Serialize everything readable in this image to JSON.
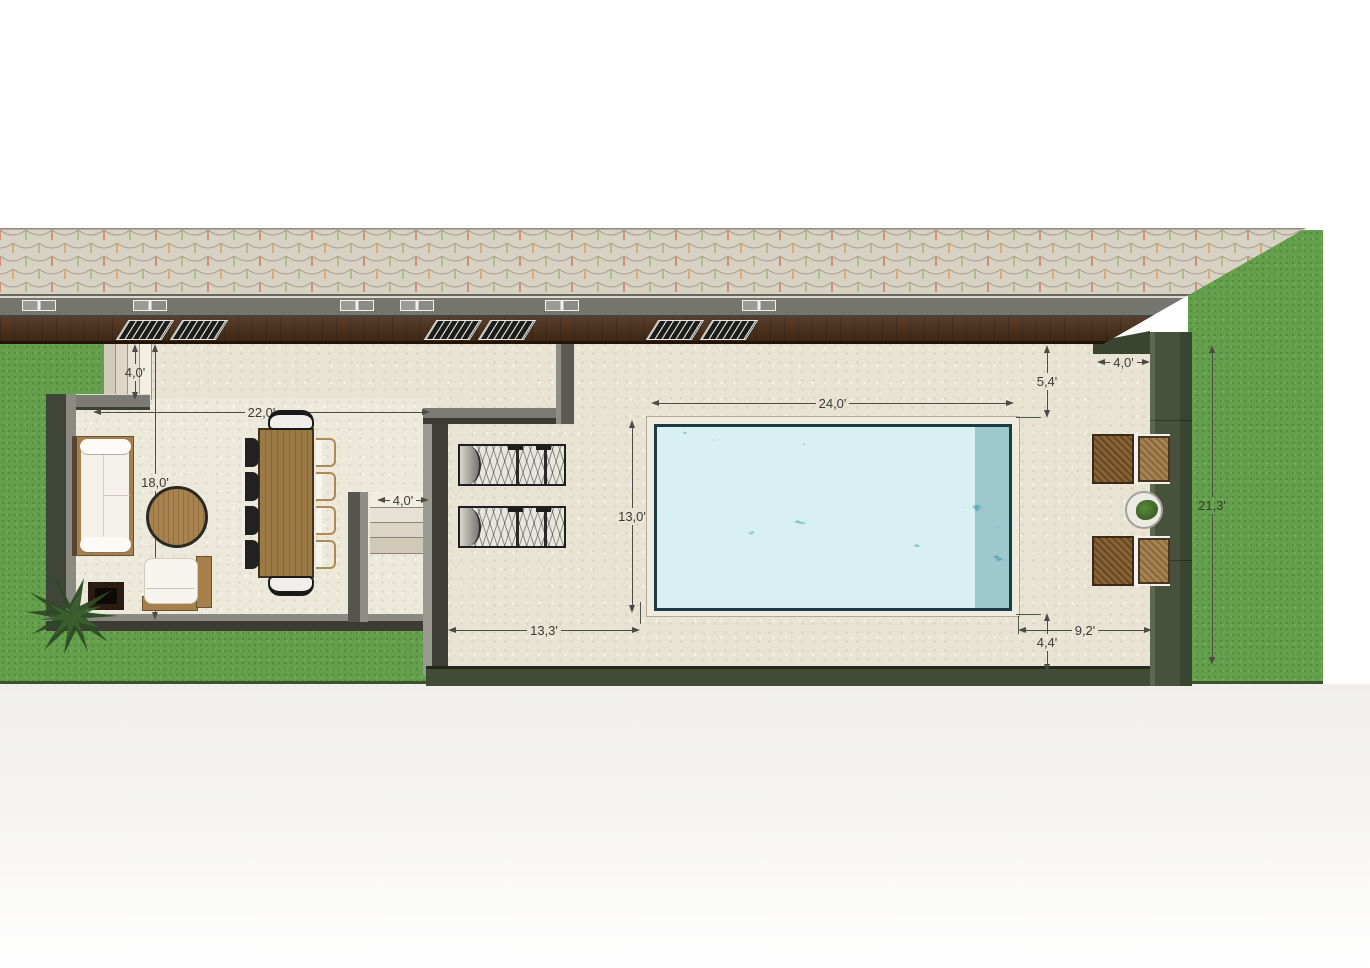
{
  "scene": {
    "title": "Villa terrace and pool site plan — top view",
    "units": "feet"
  },
  "dims": {
    "steps_depth": {
      "label": "4,0'"
    },
    "living_width": {
      "label": "22,0'"
    },
    "living_depth": {
      "label": "18,0'"
    },
    "stair_width": {
      "label": "4,0'"
    },
    "walk_left": {
      "label": "13,3'"
    },
    "pool_length": {
      "label": "24,0'"
    },
    "pool_width": {
      "label": "13,0'"
    },
    "deck_top": {
      "label": "5,4'"
    },
    "deck_corner": {
      "label": "4,0'"
    },
    "deck_bottom": {
      "label": "4,4'"
    },
    "deck_right": {
      "label": "9,2'"
    },
    "garden_side": {
      "label": "21,3'"
    }
  },
  "palette": {
    "lawn": "#649f4b",
    "lawn_edge": "#3d5130",
    "wall_green": "#46523c",
    "wall_gray": "#75756f",
    "wall_dark": "#3c3c35",
    "terrace_floor": "#e9e3d3",
    "living_floor": "#ece8da",
    "roof_tile": "#d8d2c5",
    "roof_fascia": "#75756f",
    "house_band": "#4d3423",
    "pool_water": "#6cb9c2",
    "pool_caustic": "#c2e8ea",
    "pool_coping": "#f0ebdf",
    "wood": "#a5804d",
    "cushion": "#f5f4ef",
    "chair_dark": "#21211f",
    "wicker": "#8a6234",
    "dim_text": "#3b3b33"
  }
}
